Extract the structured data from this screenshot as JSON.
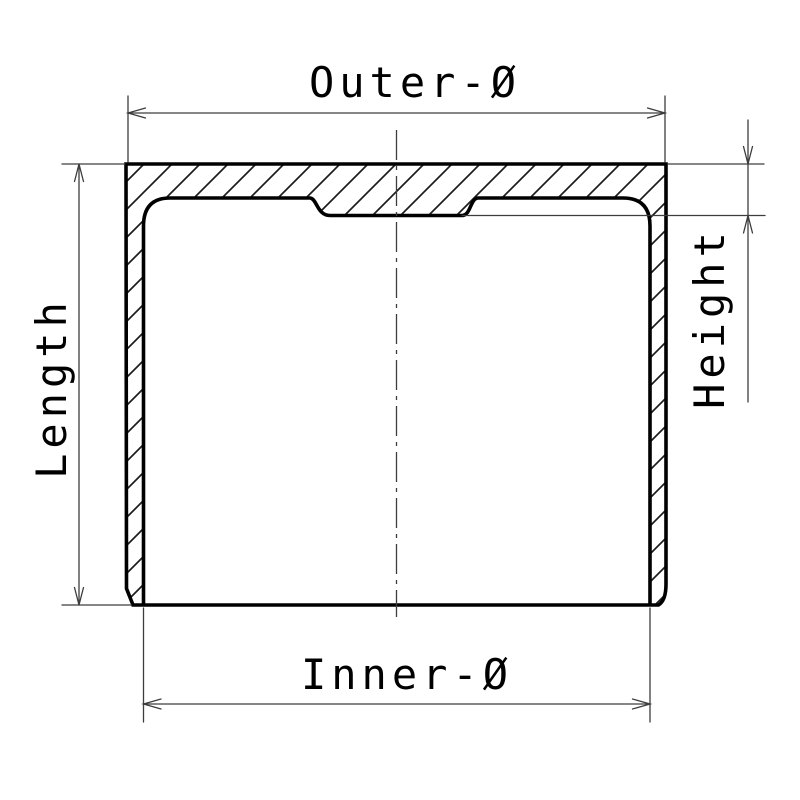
{
  "drawing": {
    "background": "#ffffff",
    "colors": {
      "outline": "#000000",
      "hatch": "#1c1c1c",
      "thin_line": "#3d3d3d",
      "text": "#000000"
    },
    "labels": {
      "outer_diameter": "Outer-Ø",
      "inner_diameter": "Inner-Ø",
      "length": "Length",
      "height": "Height"
    }
  }
}
